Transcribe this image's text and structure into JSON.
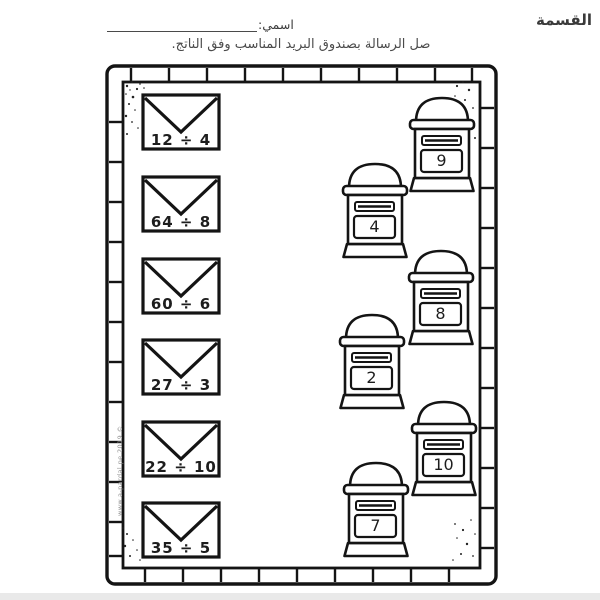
{
  "page": {
    "title": "القسمة",
    "name_label": "اسمي:",
    "instruction": "صل الرسالة بصندوق البريد المناسب وفق الناتج.",
    "watermark": "www.a-pardal.pe.2019 ©"
  },
  "envelopes": [
    {
      "expression": "12 ÷ 4"
    },
    {
      "expression": "64 ÷ 8"
    },
    {
      "expression": "60 ÷ 6"
    },
    {
      "expression": "27 ÷ 3"
    },
    {
      "expression": "22 ÷ 10"
    },
    {
      "expression": "35 ÷ 5"
    }
  ],
  "mailboxes": [
    {
      "number": "9"
    },
    {
      "number": "4"
    },
    {
      "number": "8"
    },
    {
      "number": "2"
    },
    {
      "number": "10"
    },
    {
      "number": "7"
    }
  ],
  "colors": {
    "ink": "#141414",
    "title_text": "#3a3a3a",
    "subtitle_text": "#4b4b4b",
    "watermark_text": "#909090"
  }
}
